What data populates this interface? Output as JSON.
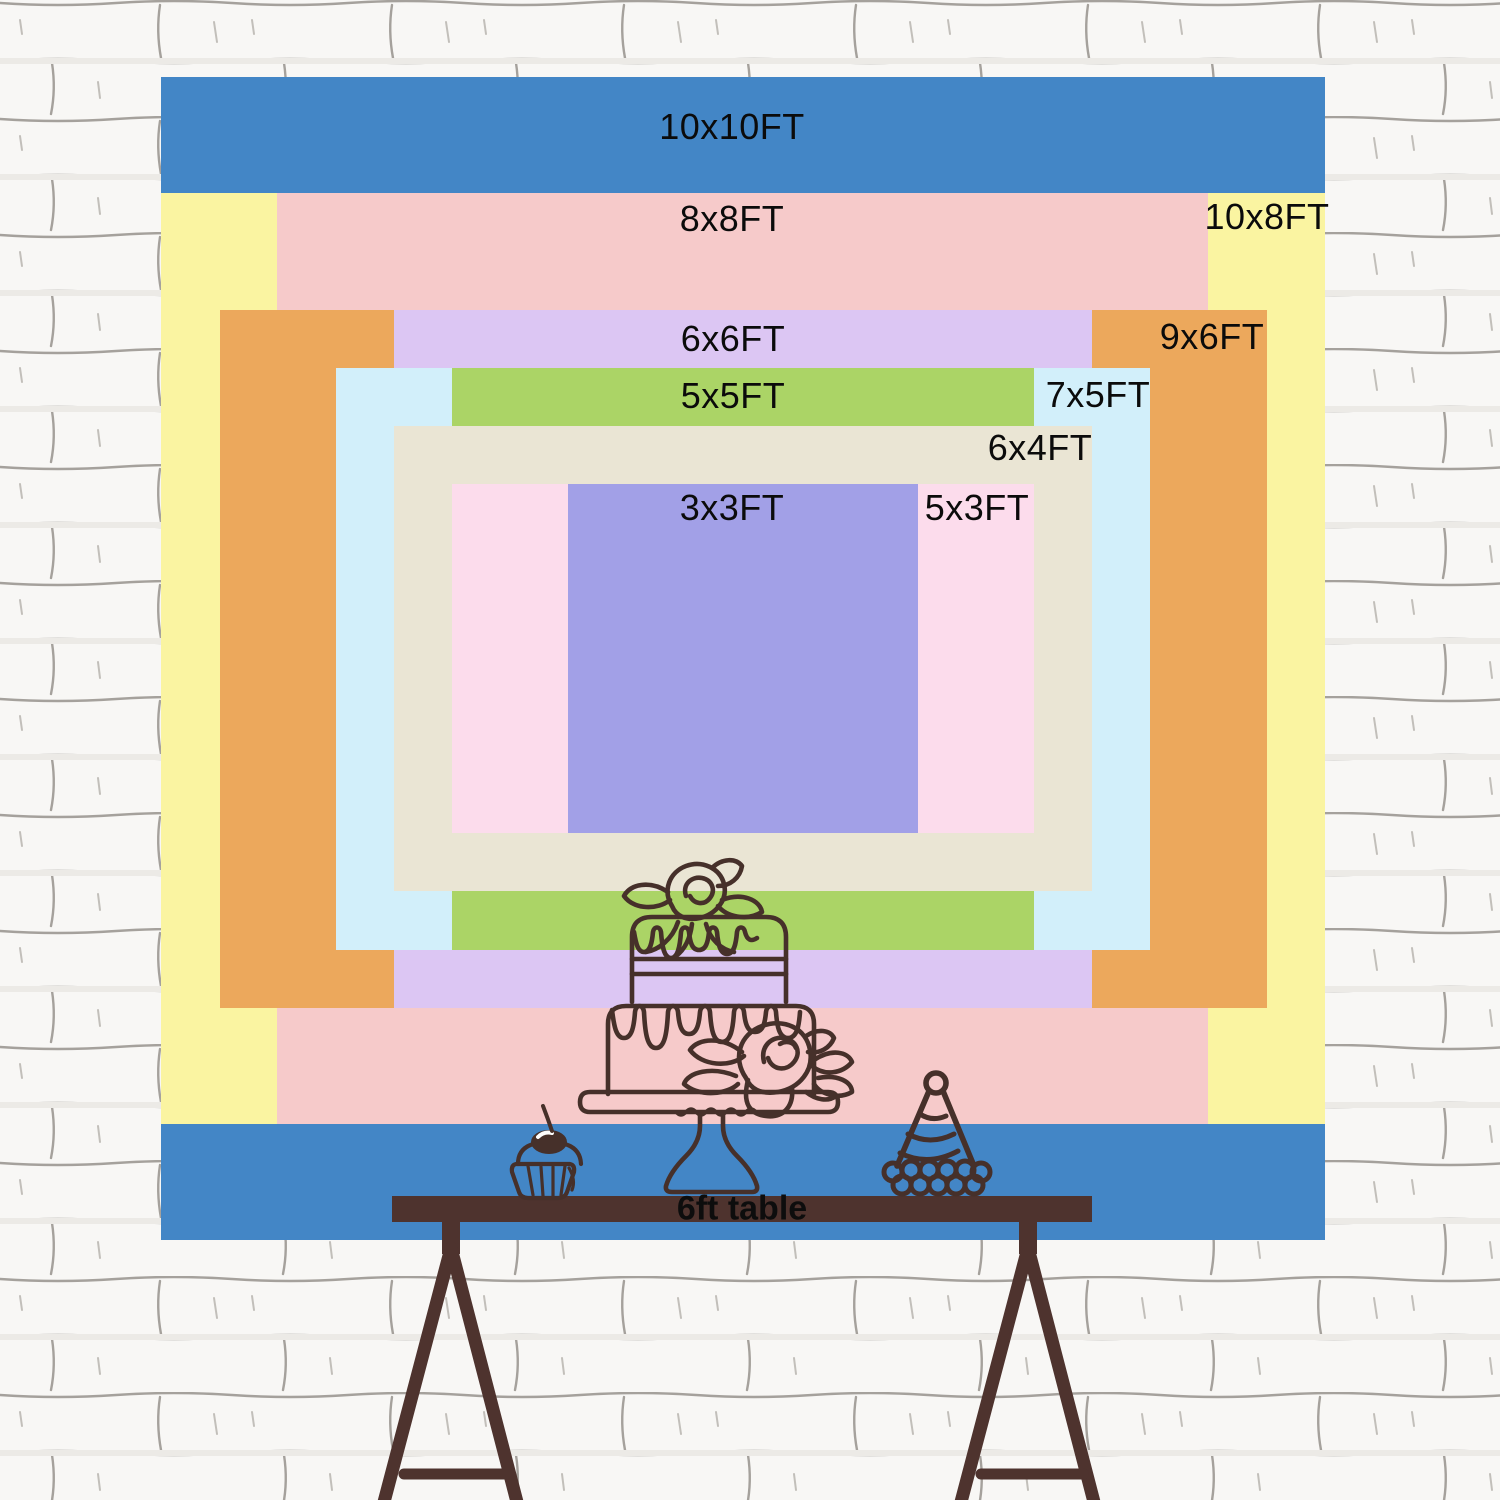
{
  "backdrop": {
    "sizes": [
      {
        "label": "10x10FT",
        "color": "#4386c6"
      },
      {
        "label": "10x8FT",
        "color": "#faf4a1"
      },
      {
        "label": "8x8FT",
        "color": "#f6caca"
      },
      {
        "label": "9x6FT",
        "color": "#eca85c"
      },
      {
        "label": "6x6FT",
        "color": "#dcc6f3"
      },
      {
        "label": "7x5FT",
        "color": "#d2effa"
      },
      {
        "label": "5x5FT",
        "color": "#abd466"
      },
      {
        "label": "6x4FT",
        "color": "#eae5d4"
      },
      {
        "label": "5x3FT",
        "color": "#fcdcec"
      },
      {
        "label": "3x3FT",
        "color": "#a2a0e7"
      }
    ],
    "table_label": "6ft table"
  },
  "illustrations": {
    "background": "white-brick-wall",
    "table": "trestle-table-silhouette",
    "cake": "two-tier-cake-line-art",
    "cupcake": "cupcake-with-cherry-line-art",
    "party_hat": "party-hat-line-art"
  },
  "colors": {
    "line_art": "#46302a",
    "table": "#4e332e",
    "label_text": "#0b0b0b",
    "wall_base": "#f8f7f5",
    "wall_line": "#a5a19c"
  }
}
